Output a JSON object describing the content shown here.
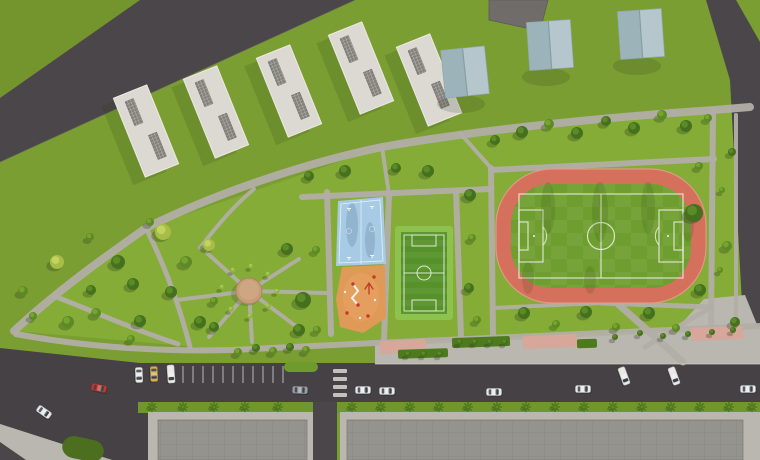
{
  "scene": {
    "width": 760,
    "height": 460,
    "colors": {
      "grass_base": "#7a9e31",
      "grass_outer": "#74942e",
      "grass_park": "#84ac37",
      "grass_strip": "#6f972e",
      "lawn_dark": "#4c6e1f",
      "road": "#4a4649",
      "road_main": "#454144",
      "path": "#b2aea6",
      "sidewalk": "#bab7b0",
      "curb": "#d4d1c9",
      "track": "#d4705c",
      "track_rim": "#e09a87",
      "field": "#6f9e30",
      "line_white": "#eaf1e0",
      "mini_trim": "#8ec24e",
      "mini_field": "#569129",
      "court": "#a8cbe5",
      "court_shadow": "#33506e",
      "playground": "#e09a58",
      "red": "#c0392b",
      "plaza": "#c59d79",
      "plaza_rim": "#ab865f",
      "pink": "#d6a79a",
      "hedge": "#4e7a1e",
      "island": "#6f9a2c",
      "building_white": "#dbd9d2",
      "building_edge": "#edeae3",
      "vent": "#83817b",
      "gable_left": "#9db3ba",
      "gable_right": "#b5c7cc",
      "gable_ridge": "#859ea6",
      "gable_edge": "#8ea6ad",
      "building_dark": "#6f6c69",
      "building_gray": "#95938e",
      "roof_line": "#7f7d78",
      "palm": "#46721f",
      "shadow": "#26341a",
      "glass": "#39434f",
      "car": {
        "white": [
          "#eae9e6",
          "#b8b7b3"
        ],
        "red": [
          "#bf3a2f",
          "#8e2a22"
        ],
        "yellow": [
          "#d3ae57",
          "#a8853c"
        ],
        "gray": [
          "#9aa0a3",
          "#70767a"
        ]
      },
      "tree": {
        "d": [
          "#45701d",
          "#5b8b26"
        ],
        "m": [
          "#5d8a24",
          "#75a52f"
        ],
        "l": [
          "#7fa82c",
          "#99bf3f"
        ],
        "y": [
          "#a7bd48",
          "#c2d460"
        ],
        "s": [
          "#8fb43a",
          "#a8cc50"
        ]
      }
    },
    "ground": {
      "park": "14,331 146,228 382,147 714,110 760,107 760,326 490,338 232,350",
      "top_left_tri": "0,0 140,0 0,98"
    },
    "roads": {
      "top_left": "0,98 140,0 355,0 0,162",
      "right": "706,0 736,0 760,42 760,342 744,342 730,80",
      "main": "0,348 140,363 760,363 760,402 152,402 152,460 112,460 0,424",
      "vertical": [
        313,
        402,
        24,
        58
      ],
      "corner": "0,442 26,460 0,460"
    },
    "bottom": {
      "green_strip": [
        138,
        402,
        622,
        11
      ],
      "sidewalks": [
        [
          148,
          412,
          167,
          48
        ],
        [
          340,
          412,
          420,
          48
        ]
      ],
      "buildings": [
        [
          158,
          420,
          149,
          40
        ],
        [
          347,
          420,
          396,
          40
        ]
      ],
      "bl_sidewalk": "0,424 112,460 0,460",
      "bl_patch": [
        62,
        438,
        42,
        22,
        12
      ],
      "plaza_br": "704,299 745,295 760,332 760,361 640,361 668,338"
    },
    "paths": [
      {
        "d": "M14,331 C60,288 112,252 146,228 C210,196 300,164 382,147 C460,133 580,119 714,110 L750,107",
        "w": 8
      },
      {
        "d": "M16,334 C80,346 150,352 232,350 L375,343 L490,338 L760,326",
        "w": 6
      },
      {
        "d": "M146,228 C166,268 180,308 190,347",
        "w": 5
      },
      {
        "d": "M54,296 C95,312 140,332 178,344",
        "w": 5
      },
      {
        "d": "M200,248 C218,224 236,204 254,189",
        "w": 4
      },
      {
        "d": "M249,291 L207,253",
        "w": 4
      },
      {
        "d": "M249,291 L299,259",
        "w": 4
      },
      {
        "d": "M249,291 L326,293",
        "w": 4
      },
      {
        "d": "M249,291 L297,327",
        "w": 4
      },
      {
        "d": "M249,291 L252,342",
        "w": 4
      },
      {
        "d": "M249,291 L209,337",
        "w": 4
      },
      {
        "d": "M249,291 L177,300",
        "w": 4
      },
      {
        "d": "M327,192 L331,334",
        "w": 6
      },
      {
        "d": "M389,194 L384,340",
        "w": 6
      },
      {
        "d": "M456,191 L461,337",
        "w": 6
      },
      {
        "d": "M491,168 L493,336",
        "w": 6
      },
      {
        "d": "M302,197 L491,189",
        "w": 6
      },
      {
        "d": "M382,147 L389,194",
        "w": 4
      },
      {
        "d": "M460,133 L491,168",
        "w": 4
      },
      {
        "d": "M491,170 L714,159",
        "w": 6
      },
      {
        "d": "M713,110 L711,332",
        "w": 6
      },
      {
        "d": "M736,115 L736,330",
        "w": 4
      },
      {
        "d": "M493,308 L601,303",
        "w": 4
      },
      {
        "d": "M601,303 L711,307",
        "w": 5
      },
      {
        "d": "M618,304 L683,362",
        "w": 7
      },
      {
        "d": "M711,307 L645,347",
        "w": 5
      }
    ],
    "promenade": {
      "band": "375,343 760,326 760,364 375,364",
      "pink": [
        [
          380,
          340,
          46,
          13
        ],
        [
          523,
          335,
          54,
          13
        ],
        [
          691,
          327,
          52,
          13
        ]
      ],
      "hedges": [
        [
          452,
          337,
          58,
          10
        ],
        [
          398,
          349,
          50,
          9
        ],
        [
          577,
          339,
          20,
          9
        ]
      ]
    },
    "parking": {
      "stall_x": [
        183,
        193,
        203,
        213,
        223,
        233,
        243,
        253,
        263,
        273,
        283
      ],
      "y1": 366,
      "y2": 383,
      "island": [
        284,
        362,
        34,
        10
      ],
      "crosswalk": {
        "x": 333,
        "w": 14,
        "ys": [
          369,
          377,
          385,
          393
        ],
        "h": 4
      },
      "curb": [
        375,
        364,
        760,
        364
      ]
    },
    "track": {
      "outer": [
        496,
        169,
        210,
        134,
        56
      ],
      "field": [
        511,
        184,
        180,
        104,
        40
      ],
      "border": [
        519,
        194,
        164,
        84
      ],
      "circle": [
        601,
        236,
        13.5
      ],
      "vline": [
        601,
        194,
        601,
        278
      ],
      "pen_left": [
        519,
        210,
        24,
        52
      ],
      "goal_left": [
        519,
        222,
        9,
        28
      ],
      "pen_right": [
        659,
        210,
        24,
        52
      ],
      "goal_right": [
        674,
        222,
        9,
        28
      ],
      "arc_left": "M543,227 A13,13 0 0 1 543,245",
      "arc_right": "M659,227 A13,13 0 0 0 659,245",
      "spots": [
        [
          534,
          236
        ],
        [
          668,
          236
        ]
      ],
      "streaks": [
        [
          548,
          208,
          7,
          26
        ],
        [
          600,
          212,
          8,
          30
        ],
        [
          648,
          208,
          7,
          26
        ],
        [
          688,
          224,
          6,
          18
        ],
        [
          528,
          278,
          6,
          16
        ],
        [
          590,
          280,
          6,
          14
        ]
      ]
    },
    "mini_field": {
      "outer": [
        395,
        226,
        58,
        94
      ],
      "inner": [
        401,
        232,
        46,
        82
      ],
      "border": [
        404,
        235,
        40,
        76
      ],
      "hline": [
        404,
        273,
        444,
        273
      ],
      "circle": [
        424,
        273,
        7
      ],
      "box_top": [
        412,
        235,
        24,
        11
      ],
      "box_bottom": [
        412,
        300,
        24,
        11
      ]
    },
    "court": {
      "poly": "338,201 383,197 386,264 336,266",
      "inner": "341,204 380,200 383,261 339,263",
      "vline": [
        361,
        200,
        361,
        264
      ],
      "hoops": [
        [
          349,
          208
        ],
        [
          372,
          206
        ],
        [
          349,
          257
        ],
        [
          372,
          255
        ]
      ],
      "circles": [
        [
          349,
          231
        ],
        [
          372,
          229
        ]
      ],
      "streaks": [
        [
          352,
          225,
          6,
          22
        ],
        [
          370,
          240,
          5,
          18
        ]
      ]
    },
    "playground": {
      "poly": "342,267 385,265 386,318 363,333 340,327 336,299",
      "zigzag": "M353,284 L358,291 L352,298 L358,305",
      "frame": "M365,289 L369,283 L373,289 M369,283 L369,294",
      "red_dots": [
        [
          353,
          284
        ],
        [
          358,
          305
        ],
        [
          347,
          313
        ],
        [
          368,
          316
        ],
        [
          374,
          277
        ]
      ],
      "white_dots": [
        [
          360,
          318
        ],
        [
          345,
          292
        ],
        [
          375,
          300
        ]
      ]
    },
    "plaza": {
      "cx": 249,
      "cy": 291,
      "r": 13
    },
    "buildings": {
      "apartments": {
        "rot": -22,
        "w": 36,
        "h": 85,
        "vent": [
          9,
          26
        ],
        "vents": [
          [
            -4,
            -22
          ],
          [
            5,
            18
          ]
        ],
        "pos": [
          [
            146,
            131
          ],
          [
            216,
            112
          ],
          [
            289,
            91
          ],
          [
            361,
            68
          ],
          [
            429,
            80
          ]
        ]
      },
      "gabled": {
        "w": 44,
        "h": 48,
        "pos": [
          [
            465,
            72,
            -6
          ],
          [
            550,
            45,
            -4
          ],
          [
            641,
            34,
            -4
          ]
        ]
      },
      "dark_poly": "489,0 548,0 540,31 489,20"
    },
    "trees": [
      [
        57,
        262,
        7,
        "y"
      ],
      [
        23,
        291,
        5,
        "m"
      ],
      [
        68,
        322,
        6,
        "m"
      ],
      [
        90,
        237,
        4,
        "m"
      ],
      [
        118,
        262,
        7,
        "d"
      ],
      [
        91,
        290,
        5,
        "d"
      ],
      [
        133,
        284,
        6,
        "d"
      ],
      [
        96,
        313,
        5,
        "m"
      ],
      [
        140,
        321,
        6,
        "d"
      ],
      [
        163,
        232,
        8,
        "y"
      ],
      [
        186,
        262,
        6,
        "m"
      ],
      [
        171,
        292,
        6,
        "d"
      ],
      [
        131,
        339,
        4,
        "m"
      ],
      [
        200,
        322,
        6,
        "d"
      ],
      [
        214,
        301,
        4,
        "m"
      ],
      [
        33,
        316,
        4,
        "m"
      ],
      [
        209,
        245,
        6,
        "y"
      ],
      [
        287,
        249,
        6,
        "d"
      ],
      [
        303,
        300,
        8,
        "d"
      ],
      [
        214,
        327,
        5,
        "d"
      ],
      [
        299,
        330,
        6,
        "d"
      ],
      [
        150,
        222,
        4,
        "m"
      ],
      [
        233,
        270,
        2.5,
        "s"
      ],
      [
        251,
        266,
        2.5,
        "s"
      ],
      [
        268,
        274,
        2.5,
        "s"
      ],
      [
        231,
        309,
        2.5,
        "s"
      ],
      [
        250,
        316,
        2.5,
        "s"
      ],
      [
        268,
        306,
        2.5,
        "s"
      ],
      [
        222,
        287,
        2.5,
        "s"
      ],
      [
        277,
        291,
        2.5,
        "s"
      ],
      [
        309,
        176,
        5,
        "d"
      ],
      [
        345,
        171,
        6,
        "d"
      ],
      [
        396,
        168,
        5,
        "d"
      ],
      [
        428,
        171,
        6,
        "d"
      ],
      [
        470,
        195,
        6,
        "d"
      ],
      [
        472,
        238,
        4,
        "m"
      ],
      [
        469,
        288,
        5,
        "d"
      ],
      [
        477,
        320,
        4,
        "m"
      ],
      [
        495,
        140,
        5,
        "d"
      ],
      [
        522,
        132,
        6,
        "d"
      ],
      [
        549,
        124,
        5,
        "m"
      ],
      [
        577,
        133,
        6,
        "d"
      ],
      [
        606,
        121,
        5,
        "d"
      ],
      [
        634,
        128,
        6,
        "d"
      ],
      [
        662,
        115,
        5,
        "m"
      ],
      [
        686,
        126,
        6,
        "d"
      ],
      [
        708,
        118,
        4,
        "m"
      ],
      [
        694,
        213,
        9,
        "d"
      ],
      [
        700,
        290,
        6,
        "d"
      ],
      [
        732,
        152,
        4,
        "d"
      ],
      [
        699,
        166,
        4,
        "m"
      ],
      [
        727,
        246,
        5,
        "m"
      ],
      [
        735,
        322,
        5,
        "d"
      ],
      [
        524,
        313,
        6,
        "d"
      ],
      [
        556,
        324,
        4,
        "m"
      ],
      [
        586,
        312,
        6,
        "d"
      ],
      [
        616,
        327,
        4,
        "m"
      ],
      [
        649,
        313,
        6,
        "d"
      ],
      [
        676,
        328,
        4,
        "m"
      ],
      [
        722,
        190,
        3,
        "m"
      ],
      [
        720,
        270,
        3,
        "m"
      ],
      [
        317,
        330,
        4,
        "m"
      ],
      [
        316,
        250,
        4,
        "m"
      ],
      [
        238,
        352,
        4,
        "m"
      ],
      [
        256,
        348,
        4,
        "d"
      ],
      [
        273,
        351,
        4,
        "m"
      ],
      [
        290,
        347,
        4,
        "d"
      ],
      [
        306,
        350,
        4,
        "m"
      ],
      [
        615,
        337,
        3,
        "d"
      ],
      [
        640,
        333,
        3,
        "d"
      ],
      [
        663,
        336,
        3,
        "d"
      ],
      [
        688,
        334,
        3,
        "d"
      ],
      [
        712,
        332,
        3,
        "d"
      ],
      [
        733,
        330,
        3,
        "d"
      ],
      [
        460,
        342,
        3,
        "d"
      ],
      [
        475,
        342,
        3,
        "d"
      ],
      [
        490,
        342,
        3,
        "d"
      ],
      [
        505,
        342,
        3,
        "d"
      ],
      [
        408,
        354,
        3,
        "d"
      ],
      [
        424,
        354,
        3,
        "d"
      ],
      [
        440,
        354,
        3,
        "d"
      ]
    ],
    "palms": {
      "y": 407,
      "xs": [
        152,
        183,
        214,
        245,
        278,
        352,
        381,
        410,
        439,
        468,
        497,
        526,
        555,
        584,
        613,
        642,
        671,
        700,
        729,
        752
      ]
    },
    "cars": [
      [
        99,
        388,
        12,
        "red",
        "car"
      ],
      [
        44,
        412,
        35,
        "white",
        "car"
      ],
      [
        300,
        390,
        2,
        "gray",
        "car"
      ],
      [
        363,
        390,
        0,
        "white",
        "car"
      ],
      [
        387,
        391,
        0,
        "white",
        "car"
      ],
      [
        494,
        392,
        0,
        "white",
        "car"
      ],
      [
        583,
        389,
        0,
        "white",
        "car"
      ],
      [
        748,
        389,
        0,
        "white",
        "car"
      ],
      [
        624,
        376,
        70,
        "white",
        "van"
      ],
      [
        674,
        376,
        70,
        "white",
        "van"
      ],
      [
        139,
        375,
        88,
        "white",
        "car"
      ],
      [
        154,
        374,
        88,
        "yellow",
        "car"
      ],
      [
        171,
        374,
        86,
        "white",
        "van"
      ]
    ]
  }
}
